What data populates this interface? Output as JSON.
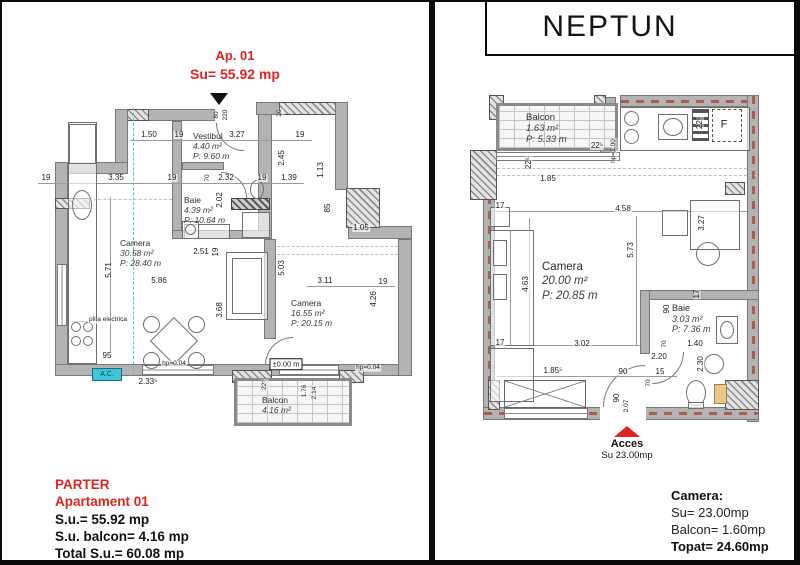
{
  "colors": {
    "accent_red": "#e02420",
    "cyan": "#3ec6d8",
    "wall_gray": "#b3b3b3",
    "hatch_red": "#a85f52"
  },
  "left": {
    "header": {
      "line1": "Ap. 01",
      "line2": "Su= 55.92 mp"
    },
    "rooms": [
      {
        "name": "Camera",
        "area": "30.58 m²",
        "perimeter": "P: 28.40 m"
      },
      {
        "name": "Vestibul",
        "area": "4.40 m²",
        "perimeter": "P: 9.60 m"
      },
      {
        "name": "Baie",
        "area": "4.39 m²",
        "perimeter": "P: 10.64 m"
      },
      {
        "name": "Camera",
        "area": "16.55 m²",
        "perimeter": "P: 20.15 m"
      },
      {
        "name": "Balcon",
        "area": "4.16 m²",
        "perimeter": ""
      }
    ],
    "ac_label": "A.C.",
    "labels": [
      {
        "t": "1.50",
        "x": 147,
        "y": 133
      },
      {
        "t": "19",
        "x": 177,
        "y": 133
      },
      {
        "t": "3.27",
        "x": 235,
        "y": 133
      },
      {
        "t": "19",
        "x": 298,
        "y": 133
      },
      {
        "t": "80",
        "x": 215,
        "y": 113,
        "v": 1,
        "s": 1
      },
      {
        "t": "220",
        "x": 224,
        "y": 113,
        "v": 1,
        "s": 1
      },
      {
        "t": "20",
        "x": 278,
        "y": 111,
        "v": 1,
        "s": 1
      },
      {
        "t": "19",
        "x": 44,
        "y": 176
      },
      {
        "t": "3.35",
        "x": 114,
        "y": 176
      },
      {
        "t": "19",
        "x": 170,
        "y": 176
      },
      {
        "t": "70",
        "x": 206,
        "y": 176,
        "v": 1,
        "s": 1
      },
      {
        "t": "2.32",
        "x": 224,
        "y": 176
      },
      {
        "t": "19",
        "x": 260,
        "y": 176
      },
      {
        "t": "1.39",
        "x": 287,
        "y": 176
      },
      {
        "t": "2.45",
        "x": 280,
        "y": 156,
        "v": 1
      },
      {
        "t": "1.13",
        "x": 319,
        "y": 168,
        "v": 1
      },
      {
        "t": "2.02",
        "x": 218,
        "y": 198,
        "v": 1
      },
      {
        "t": "85",
        "x": 326,
        "y": 206,
        "v": 1
      },
      {
        "t": "1.05",
        "x": 359,
        "y": 226
      },
      {
        "t": "5.71",
        "x": 107,
        "y": 268,
        "v": 1
      },
      {
        "t": "5.86",
        "x": 157,
        "y": 279
      },
      {
        "t": "2.51",
        "x": 199,
        "y": 250
      },
      {
        "t": "19",
        "x": 214,
        "y": 250,
        "v": 1
      },
      {
        "t": "5.03",
        "x": 280,
        "y": 266,
        "v": 1
      },
      {
        "t": "3.11",
        "x": 323,
        "y": 279
      },
      {
        "t": "19",
        "x": 381,
        "y": 280
      },
      {
        "t": "4.26",
        "x": 372,
        "y": 297,
        "v": 1
      },
      {
        "t": "3.68",
        "x": 218,
        "y": 308,
        "v": 1
      },
      {
        "t": "95",
        "x": 105,
        "y": 354
      },
      {
        "t": "2.33⁵",
        "x": 146,
        "y": 380
      },
      {
        "t": "22⁵",
        "x": 263,
        "y": 383,
        "v": 1,
        "s": 1
      },
      {
        "t": "1.76",
        "x": 303,
        "y": 389,
        "v": 1,
        "s": 1
      },
      {
        "t": "2.14",
        "x": 313,
        "y": 391,
        "v": 1,
        "s": 1
      },
      {
        "t": "hp=0.04",
        "x": 172,
        "y": 362,
        "s": 1
      },
      {
        "t": "hp=0.04",
        "x": 366,
        "y": 366,
        "s": 1
      },
      {
        "t": "±0.00 m",
        "x": 284,
        "y": 362,
        "cls": "boxed"
      },
      {
        "t": "plita electrica",
        "x": 106,
        "y": 318,
        "s": 1
      }
    ],
    "summary": {
      "line1": "PARTER",
      "line2": "Apartament 01",
      "line3": "S.u.= 55.92 mp",
      "line4": "S.u. balcon= 4.16 mp",
      "line5": "Total S.u.= 60.08 mp"
    }
  },
  "right": {
    "title": "NEPTUN",
    "rooms": [
      {
        "name": "Balcon",
        "area": "1.63 m²",
        "perimeter": "P: 5.33 m"
      },
      {
        "name": "Camera",
        "area": "20.00 m²",
        "perimeter": "P: 20.85 m"
      },
      {
        "name": "Baie",
        "area": "3.03 m²",
        "perimeter": "P: 7.36 m"
      }
    ],
    "labels": [
      {
        "t": "22⁵",
        "x": 595,
        "y": 144
      },
      {
        "t": "22⁵",
        "x": 527,
        "y": 161,
        "v": 1
      },
      {
        "t": "1.85",
        "x": 546,
        "y": 177
      },
      {
        "t": "hp=1.00",
        "x": 612,
        "y": 149,
        "v": 1,
        "s": 1
      },
      {
        "t": "22⁵",
        "x": 698,
        "y": 121,
        "v": 1
      },
      {
        "t": "F",
        "x": 722,
        "y": 123,
        "cls": "flabel"
      },
      {
        "t": "17",
        "x": 498,
        "y": 204
      },
      {
        "t": "4.58",
        "x": 621,
        "y": 207
      },
      {
        "t": "5.73",
        "x": 629,
        "y": 248,
        "v": 1
      },
      {
        "t": "4.63",
        "x": 524,
        "y": 282,
        "v": 1
      },
      {
        "t": "3.27",
        "x": 700,
        "y": 221,
        "v": 1
      },
      {
        "t": "17",
        "x": 498,
        "y": 341
      },
      {
        "t": "3.02",
        "x": 580,
        "y": 342
      },
      {
        "t": "1.85⁵",
        "x": 551,
        "y": 369
      },
      {
        "t": "90",
        "x": 621,
        "y": 370
      },
      {
        "t": "15",
        "x": 658,
        "y": 370
      },
      {
        "t": "90",
        "x": 665,
        "y": 307,
        "v": 1
      },
      {
        "t": "17",
        "x": 695,
        "y": 292,
        "v": 1
      },
      {
        "t": "1.40",
        "x": 693,
        "y": 342
      },
      {
        "t": "70",
        "x": 663,
        "y": 342,
        "v": 1,
        "s": 1
      },
      {
        "t": "2.20",
        "x": 657,
        "y": 355
      },
      {
        "t": "2.30",
        "x": 699,
        "y": 362,
        "v": 1
      },
      {
        "t": "70",
        "x": 647,
        "y": 381,
        "v": 1,
        "s": 1
      },
      {
        "t": "90",
        "x": 615,
        "y": 396,
        "v": 1
      },
      {
        "t": "2.07",
        "x": 625,
        "y": 404,
        "v": 1,
        "s": 1
      }
    ],
    "access": {
      "label": "Acces",
      "sub": "Su 23.00mp"
    },
    "summary": {
      "title": "Camera:",
      "line1": "Su= 23.00mp",
      "line2": "Balcon= 1.60mp",
      "total": "Topat= 24.60mp"
    }
  }
}
